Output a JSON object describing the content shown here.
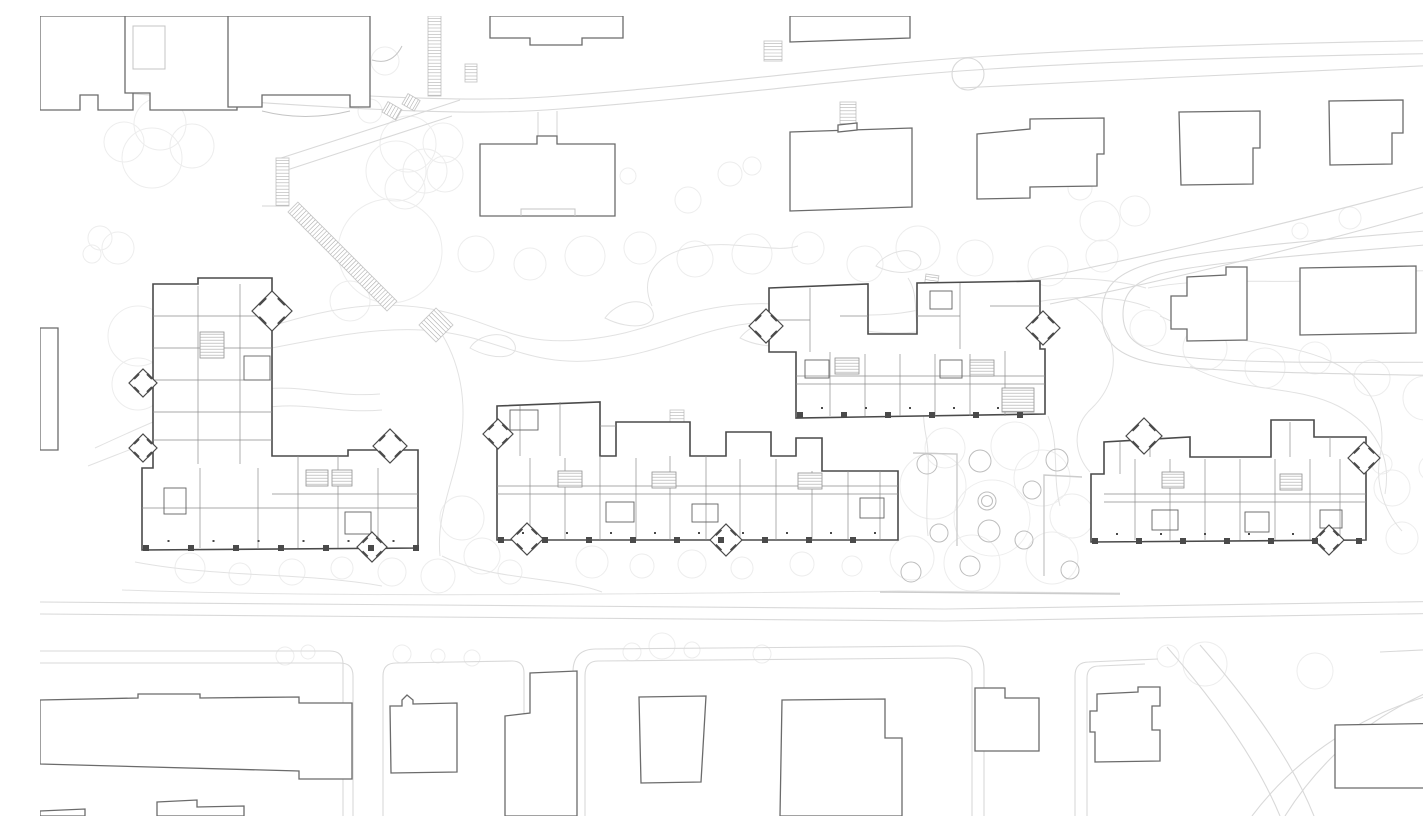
{
  "document": {
    "type": "architectural-site-plan",
    "description": "ground-floor site plan, residential buildings with context",
    "visible_text": []
  },
  "canvas": {
    "width": 1423,
    "height": 800,
    "background": "#ffffff"
  },
  "colors": {
    "detail_wall": "#4a4a4a",
    "detail_partition": "#8d8d8d",
    "context_wall": "#6b6b6b",
    "context_light": "#c4c4c4",
    "road": "#d9d9d9",
    "path": "#e2e2e2",
    "tree": "#ededed",
    "ring": "#bdbdbd",
    "garden_wall": "#cccccc",
    "ramp_edge": "#c9c9c9",
    "ramp_rung": "#b0b0b0",
    "stair_rung": "#a8a8a8",
    "room": "#626262",
    "white": "#ffffff"
  },
  "plan": {
    "trees": [
      [
        120,
        108,
        26
      ],
      [
        84,
        126,
        20
      ],
      [
        112,
        142,
        30
      ],
      [
        152,
        130,
        22
      ],
      [
        60,
        222,
        12
      ],
      [
        78,
        232,
        16
      ],
      [
        52,
        238,
        9
      ],
      [
        98,
        320,
        30
      ],
      [
        98,
        368,
        26
      ],
      [
        205,
        380,
        12
      ],
      [
        350,
        235,
        52
      ],
      [
        368,
        128,
        28
      ],
      [
        385,
        155,
        22
      ],
      [
        356,
        155,
        30
      ],
      [
        330,
        95,
        12
      ],
      [
        345,
        45,
        14
      ],
      [
        403,
        127,
        20
      ],
      [
        405,
        158,
        18
      ],
      [
        365,
        173,
        20
      ],
      [
        310,
        285,
        20
      ],
      [
        436,
        238,
        18
      ],
      [
        490,
        248,
        16
      ],
      [
        545,
        240,
        20
      ],
      [
        600,
        232,
        16
      ],
      [
        655,
        243,
        18
      ],
      [
        712,
        238,
        20
      ],
      [
        768,
        232,
        16
      ],
      [
        825,
        248,
        18
      ],
      [
        878,
        232,
        22
      ],
      [
        935,
        242,
        18
      ],
      [
        1008,
        250,
        20
      ],
      [
        1062,
        240,
        16
      ],
      [
        690,
        158,
        12
      ],
      [
        712,
        150,
        9
      ],
      [
        648,
        184,
        13
      ],
      [
        548,
        182,
        11
      ],
      [
        492,
        162,
        9
      ],
      [
        588,
        160,
        8
      ],
      [
        760,
        180,
        10
      ],
      [
        800,
        165,
        9
      ],
      [
        985,
        162,
        10
      ],
      [
        1040,
        172,
        12
      ],
      [
        1095,
        195,
        15
      ],
      [
        1060,
        205,
        20
      ],
      [
        1108,
        312,
        18
      ],
      [
        1165,
        332,
        22
      ],
      [
        1225,
        352,
        20
      ],
      [
        1275,
        342,
        16
      ],
      [
        1332,
        362,
        18
      ],
      [
        1385,
        382,
        22
      ],
      [
        1352,
        472,
        18
      ],
      [
        1392,
        452,
        13
      ],
      [
        1362,
        522,
        16
      ],
      [
        1402,
        545,
        12
      ],
      [
        1342,
        448,
        10
      ],
      [
        893,
        470,
        33
      ],
      [
        952,
        502,
        38
      ],
      [
        1002,
        462,
        28
      ],
      [
        932,
        547,
        28
      ],
      [
        1012,
        542,
        26
      ],
      [
        872,
        542,
        22
      ],
      [
        905,
        432,
        20
      ],
      [
        975,
        430,
        24
      ],
      [
        1032,
        500,
        22
      ],
      [
        150,
        552,
        15
      ],
      [
        200,
        558,
        11
      ],
      [
        252,
        556,
        13
      ],
      [
        302,
        552,
        11
      ],
      [
        352,
        556,
        14
      ],
      [
        398,
        560,
        17
      ],
      [
        422,
        502,
        22
      ],
      [
        442,
        540,
        18
      ],
      [
        470,
        556,
        12
      ],
      [
        552,
        546,
        16
      ],
      [
        602,
        550,
        12
      ],
      [
        652,
        548,
        14
      ],
      [
        702,
        552,
        11
      ],
      [
        762,
        548,
        12
      ],
      [
        812,
        550,
        10
      ],
      [
        245,
        640,
        9
      ],
      [
        268,
        636,
        7
      ],
      [
        362,
        638,
        9
      ],
      [
        398,
        640,
        7
      ],
      [
        432,
        642,
        8
      ],
      [
        592,
        636,
        9
      ],
      [
        622,
        630,
        13
      ],
      [
        652,
        634,
        8
      ],
      [
        722,
        638,
        9
      ],
      [
        1128,
        640,
        11
      ],
      [
        1165,
        648,
        22
      ],
      [
        1275,
        655,
        18
      ],
      [
        197,
        688,
        7
      ],
      [
        214,
        694,
        7
      ],
      [
        231,
        702,
        6
      ],
      [
        110,
        690,
        8
      ],
      [
        1310,
        202,
        11
      ],
      [
        1260,
        215,
        8
      ]
    ],
    "paths": [
      "M195,322 C260,300 320,282 385,292 C450,302 470,330 540,324 C610,318 628,296 695,289 C762,282 790,304 852,298 C914,292 930,270 992,264 C1034,260 1078,264 1106,272",
      "M178,342 C260,328 330,308 395,315 C460,322 490,352 560,344 C630,336 655,312 722,306 C789,300 815,322 877,316 C939,310 962,288 1018,283 C1055,279 1090,283 1110,292",
      "M430,332 C455,346 482,342 474,327 C466,313 438,318 430,332 Z",
      "M565,302 C592,316 620,310 612,294 C604,279 576,286 565,302 Z",
      "M700,322 C728,336 762,330 753,312 C744,296 712,306 700,322 Z",
      "M836,250 C860,262 886,256 880,242 C873,228 845,236 836,250 Z",
      "M940,330 C965,345 995,340 988,324 C980,308 950,315 940,330 Z",
      "M55,432 C120,402 165,382 215,374 C262,367 292,382 340,378",
      "M48,450 C125,420 172,400 222,392 C268,385 295,398 342,394",
      "M612,290 C600,265 612,240 648,232 C690,222 735,238 758,230",
      "M398,312 C420,345 428,385 420,430 C413,468 396,500 400,540",
      "M880,300 C890,340 878,380 886,420 C892,452 884,486 888,520",
      "M1035,282 C1080,310 1085,360 1052,392 C1030,412 1035,440 1050,456",
      "M1120,300 C1180,330 1240,322 1290,345 C1330,363 1348,400 1340,440 C1334,472 1348,500 1362,515",
      "M1150,350 C1200,378 1255,368 1298,390 C1335,409 1352,440 1345,478",
      "M1108,272 C1180,258 1262,272 1322,260 C1362,252 1400,257 1423,252",
      "M402,540 C455,566 520,560 562,576",
      "M95,546 C180,562 262,556 342,570",
      "M82,574 C300,582 600,578 858,575 L1080,577",
      "M1008,400 C1020,430 1012,460 1020,490",
      "M868,262 C880,280 872,300 880,318"
    ],
    "roads": [
      "M0,58 C300,80 420,88 520,80 C680,68 820,48 950,40 C1100,30 1300,26 1423,24",
      "M0,71 C300,93 420,101 520,93 C680,81 820,61 950,53 C1100,43 1300,39 1423,37",
      "M920,72 C1080,64 1280,54 1423,48",
      "M985,265 C1120,238 1280,200 1423,160",
      "M1010,288 C1140,262 1300,222 1423,185",
      "M1423,212 C1260,225 1150,235 1108,248 C1075,258 1062,272 1062,298 C1062,324 1075,338 1108,346 C1150,356 1260,357 1423,360",
      "M1423,226 C1270,238 1160,247 1120,258 C1093,266 1083,278 1083,298 C1083,318 1093,330 1120,337 C1160,347 1270,347 1423,346",
      "M0,586 L520,590 L905,593 L1423,585",
      "M0,598 L520,602 L905,605 L1423,597",
      "M1127,631 C1170,680 1215,740 1240,800",
      "M1160,629 C1200,675 1248,735 1274,800",
      "M1245,800 C1270,760 1310,715 1370,685 C1395,672 1412,665 1423,662",
      "M1212,800 C1242,760 1286,722 1344,696 C1384,679 1408,674 1423,672",
      "M1340,636 L1423,632",
      "M238,143 L408,88",
      "M244,155 L412,100",
      "M408,88 L420,84",
      "M222,190 L236,190",
      "M498,96 L498,121",
      "M517,95 L517,120",
      "M1393,150 L1393,360",
      "M1409,150 L1409,360"
    ],
    "road_circles": [
      [
        928,
        58,
        16
      ]
    ],
    "parcels": [
      "M0,635 L290,635 Q303,635 303,648 L303,800",
      "M0,647 L300,647 Q313,647 313,660 L313,800",
      "M343,800 L343,660 Q343,647 356,647 L472,645 Q484,645 484,657 L484,800",
      "M533,800 L533,656 Q533,633 556,633 L918,630 Q944,630 944,654 L944,800",
      "M545,800 L545,660 Q545,645 558,645 L908,642 Q932,642 932,656 L932,800",
      "M1035,800 L1035,660 Q1035,646 1049,646 L1118,643",
      "M1047,800 L1047,662 Q1047,650 1059,650 L1105,648"
    ],
    "walls": [
      "M873,437 L917,438 L917,530",
      "M1004,560 L1004,459 L1042,461",
      "M840,576 L1080,578"
    ],
    "rings": [
      [
        887,
        448,
        10
      ],
      [
        940,
        445,
        11
      ],
      [
        1017,
        444,
        11
      ],
      [
        992,
        474,
        9
      ],
      [
        899,
        517,
        9
      ],
      [
        949,
        515,
        11
      ],
      [
        984,
        524,
        9
      ],
      [
        871,
        556,
        10
      ],
      [
        930,
        550,
        10
      ],
      [
        1030,
        554,
        9
      ],
      [
        947,
        485,
        9
      ],
      [
        947,
        485,
        5.5
      ]
    ],
    "ramps": [
      [
        388,
        0,
        13,
        80,
        0
      ],
      [
        236,
        142,
        13,
        48,
        0
      ],
      [
        248,
        196,
        14,
        140,
        -45
      ],
      [
        724,
        25,
        18,
        20,
        0
      ],
      [
        800,
        86,
        16,
        26,
        0
      ],
      [
        1396,
        196,
        11,
        46,
        0
      ],
      [
        1396,
        250,
        11,
        36,
        0
      ],
      [
        342,
        96,
        12,
        16,
        -60
      ],
      [
        362,
        88,
        12,
        14,
        -60
      ],
      [
        630,
        394,
        14,
        17,
        0
      ],
      [
        886,
        258,
        13,
        40,
        8
      ],
      [
        425,
        48,
        12,
        18,
        0
      ]
    ],
    "pad": {
      "x": 384,
      "y": 297,
      "size": 24
    },
    "context": [
      "M0,0 L25,0 L25,13 L0,13 Z",
      "M0,94 L40,94 L40,79 L58,79 L58,94 L93,94 L93,0 L0,0 Z",
      "M85,0 L85,77 L110,77 L110,94 L197,94 L197,0 Z",
      "M188,0 L188,91 L222,91 L222,79 L310,79 L310,91 L330,91 L330,0 Z",
      "M450,0 L450,22 L490,22 L490,29 L542,29 L542,22 L583,22 L583,0 Z",
      "M750,0 L750,26 L870,22 L870,0 Z",
      "M750,116 L872,112 L872,191 L750,195 Z",
      "M798,109 L817,107 L817,114 L798,116 Z",
      "M440,128 L497,128 L497,120 L517,120 L517,128 L575,128 L575,200 L440,200 Z",
      "M937,118 L990,113 L990,103 L1064,102 L1064,138 L1057,138 L1057,170 L990,171 L990,182 L937,183 Z",
      "M1139,96 L1220,95 L1220,132 L1213,132 L1213,168 L1141,169 Z",
      "M1289,85 L1363,84 L1363,117 L1352,117 L1352,148 L1290,149 Z",
      "M1131,280 L1147,280 L1147,261 L1186,259 L1186,251 L1207,251 L1207,324 L1147,325 L1147,313 L1131,313 Z",
      "M1260,252 L1376,250 L1376,317 L1260,319 Z",
      "M0,312 L18,312 L18,434 L0,434 Z",
      "M0,684 L98,682 L98,678 L160,678 L160,682 L259,681 L259,687 L312,687 L312,763 L259,763 L259,755 L0,748 Z",
      "M0,795 L45,793 L45,800 L0,800 Z",
      "M117,786 L157,784 L157,791 L204,790 L204,800 L117,800 Z",
      "M350,690 L362,690 L362,684 L367,679 L373,684 L373,688 L417,687 L417,756 L351,757 Z",
      "M465,700 L490,697 L490,657 L537,655 L537,800 L465,800 Z",
      "M599,681 L666,680 L661,766 L601,767 Z",
      "M742,684 L845,683 L845,722 L862,722 L862,800 L740,800 Z",
      "M935,672 L965,672 L965,682 L999,682 L999,735 L935,735 Z",
      "M1057,678 L1098,676 L1098,671 L1120,671 L1120,690 L1112,690 L1112,714 L1120,714 L1120,745 L1055,746 L1055,716 L1050,716 L1050,695 L1057,695 Z",
      "M1295,709 L1423,707 L1423,772 L1295,772 Z"
    ],
    "context_light": [
      "M93,10 L125,10 L125,53 L93,53 Z",
      "M222,95 Q265,106 310,95",
      "M332,44 Q352,50 362,30",
      "M481,200 L481,193 L535,193 L535,200"
    ],
    "buildings": [
      {
        "id": "residential-block-west",
        "outline": "M113,268 L158,268 L158,262 L232,262 L232,440 L308,440 L308,434 L378,434 L378,532 L102,534 L102,452 L113,452 Z",
        "inner": [
          "M158,270 L158,448",
          "M200,268 L200,448",
          "M113,300 L232,300",
          "M113,332 L232,332",
          "M113,364 L232,364",
          "M113,396 L232,396",
          "M113,424 L232,424",
          "M160,452 L160,532",
          "M218,452 L218,532",
          "M258,440 L258,532",
          "M298,440 L298,532",
          "M338,452 L338,532",
          "M102,492 L378,492",
          "M232,478 L378,478"
        ],
        "rooms": [
          [
            204,
            340,
            26,
            24
          ],
          [
            124,
            472,
            22,
            26
          ],
          [
            305,
            496,
            26,
            22
          ]
        ],
        "stairs": [
          [
            160,
            316,
            24,
            26
          ],
          [
            266,
            454,
            22,
            16
          ],
          [
            292,
            454,
            20,
            16
          ]
        ],
        "bays": [
          [
            232,
            295,
            20
          ],
          [
            103,
            367,
            14
          ],
          [
            103,
            432,
            14
          ],
          [
            350,
            430,
            17
          ],
          [
            332,
            531,
            15
          ]
        ],
        "piers": [
          532,
          106,
          376,
          45
        ]
      },
      {
        "id": "residential-block-center",
        "outline": "M457,442 L457,390 L560,386 L560,440 L576,440 L576,406 L650,406 L650,440 L686,440 L686,416 L731,416 L731,440 L756,440 L756,422 L782,422 L782,455 L858,455 L858,524 L457,524 Z",
        "inner": [
          "M457,470 L858,470",
          "M457,478 L858,478",
          "M490,442 L490,524",
          "M525,442 L525,524",
          "M560,440 L560,524",
          "M596,442 L596,524",
          "M630,440 L630,524",
          "M666,440 L666,524",
          "M700,443 L700,524",
          "M736,443 L736,524",
          "M772,455 L772,524",
          "M808,455 L808,524",
          "M840,455 L840,524",
          "M480,390 L480,440",
          "M520,386 L520,440",
          "M560,410 L576,410"
        ],
        "rooms": [
          [
            566,
            486,
            28,
            20
          ],
          [
            652,
            488,
            26,
            18
          ],
          [
            820,
            482,
            24,
            20
          ],
          [
            470,
            394,
            28,
            20
          ]
        ],
        "stairs": [
          [
            518,
            455,
            24,
            16
          ],
          [
            612,
            456,
            24,
            16
          ],
          [
            758,
            457,
            24,
            16
          ]
        ],
        "bays": [
          [
            458,
            418,
            15
          ],
          [
            487,
            523,
            16
          ],
          [
            686,
            524,
            16
          ]
        ],
        "piers": [
          524,
          461,
          855,
          44
        ]
      },
      {
        "id": "residential-block-north",
        "outline": "M729,272 L828,268 L828,318 L877,318 L877,267 L1000,265 L1000,333 L1005,333 L1005,398 L756,402 L756,336 L729,336 Z",
        "inner": [
          "M756,360 L1005,360",
          "M756,368 L1005,368",
          "M790,336 L790,400",
          "M825,338 L825,400",
          "M860,338 L860,400",
          "M895,338 L895,400",
          "M930,338 L930,400",
          "M965,335 L965,400",
          "M770,272 L770,336",
          "M800,300 L828,300",
          "M729,304 L770,304",
          "M920,267 L920,333",
          "M877,300 L920,300",
          "M950,290 L1000,290"
        ],
        "rooms": [
          [
            765,
            344,
            24,
            18
          ],
          [
            900,
            344,
            22,
            18
          ],
          [
            890,
            275,
            22,
            18
          ]
        ],
        "stairs": [
          [
            795,
            342,
            24,
            16
          ],
          [
            930,
            344,
            24,
            16
          ],
          [
            962,
            372,
            32,
            24
          ]
        ],
        "bays": [
          [
            726,
            310,
            17
          ],
          [
            1003,
            312,
            17
          ]
        ],
        "piers": [
          399,
          760,
          1002,
          44
        ]
      },
      {
        "id": "residential-block-east",
        "outline": "M1051,458 L1064,458 L1064,426 L1150,421 L1150,441 L1231,441 L1231,404 L1274,404 L1274,421 L1326,421 L1326,524 L1051,526 Z",
        "inner": [
          "M1064,478 L1326,478",
          "M1064,486 L1326,486",
          "M1095,443 L1095,524",
          "M1130,443 L1130,524",
          "M1165,443 L1165,524",
          "M1200,443 L1200,524",
          "M1235,443 L1235,524",
          "M1270,443 L1270,524",
          "M1300,443 L1300,524",
          "M1080,426 L1080,458",
          "M1110,424 L1110,441",
          "M1250,406 L1250,441",
          "M1290,421 L1290,441"
        ],
        "rooms": [
          [
            1112,
            494,
            26,
            20
          ],
          [
            1205,
            496,
            24,
            20
          ],
          [
            1280,
            494,
            22,
            18
          ]
        ],
        "stairs": [
          [
            1122,
            456,
            22,
            16
          ],
          [
            1240,
            458,
            22,
            16
          ]
        ],
        "bays": [
          [
            1104,
            420,
            18
          ],
          [
            1324,
            442,
            16
          ],
          [
            1289,
            524,
            15
          ]
        ],
        "piers": [
          525,
          1055,
          1323,
          44
        ]
      }
    ]
  }
}
